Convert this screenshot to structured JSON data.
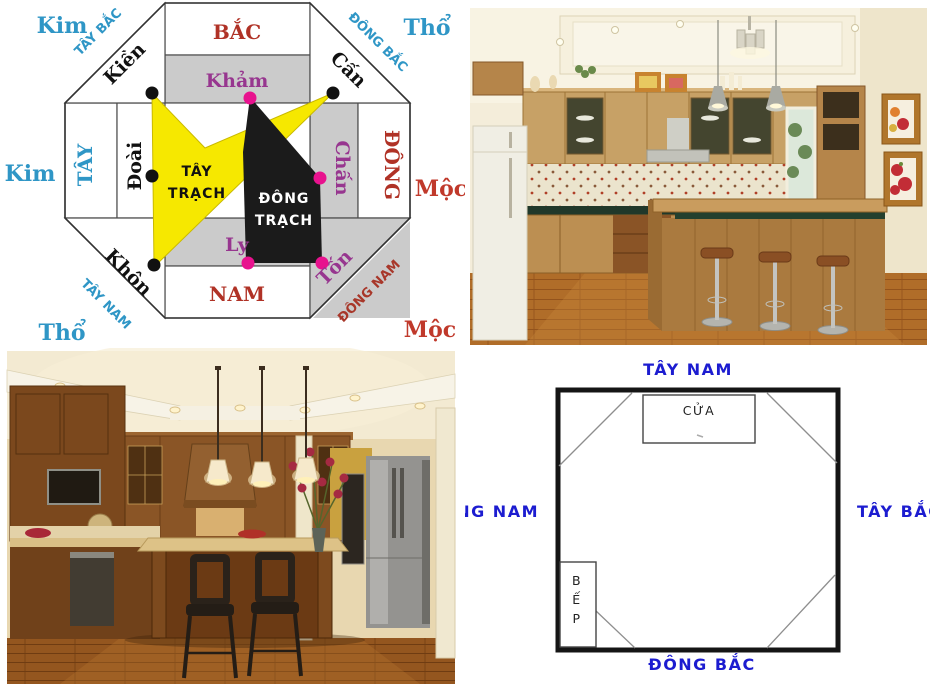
{
  "page": {
    "background": "#ffffff"
  },
  "bagua": {
    "elements": {
      "nw": "Kim",
      "ne": "Thổ",
      "w": "Kim",
      "e": "Mộc",
      "sw": "Thổ",
      "se": "Mộc"
    },
    "directions": {
      "n": "BẮC",
      "s": "NAM",
      "w": "TÂY",
      "e": "ĐÔNG",
      "nw": "TÂY BẮC",
      "ne": "ĐÔNG BẮC",
      "sw": "TÂY NAM",
      "se": "ĐÔNG NAM"
    },
    "trigrams": {
      "n": "Khảm",
      "s": "Ly",
      "w": "Đoài",
      "e": "Chấn",
      "nw": "Kiền",
      "ne": "Cấn",
      "sw": "Khôn",
      "se": "Tốn"
    },
    "west_house": {
      "line1": "TÂY",
      "line2": "TRẠCH"
    },
    "east_house": {
      "line1": "ĐÔNG",
      "line2": "TRẠCH"
    },
    "colors": {
      "element_blue": "#2f96c6",
      "element_red": "#c0392b",
      "cardinal_red": "#b03226",
      "trigram_purple": "#97368f",
      "diagonal_blue": "#2f96c6",
      "diagonal_red_dark": "#a8372a",
      "west_house_yellow": "#f6e800",
      "east_house_black": "#1b1b1b",
      "dot_black": "#111111",
      "dot_magenta": "#e8128e",
      "east_group_gray": "#cbcbcb"
    }
  },
  "floorplan": {
    "labels": {
      "top": "TÂY NAM",
      "bottom": "ĐÔNG BẮC",
      "left": "ĐÔNG NAM",
      "right": "TÂY BẮC"
    },
    "door_label": "CỬA",
    "stove_label": "BẾP",
    "stove_letters": [
      "B",
      "Ế",
      "P"
    ],
    "label_color": "#1c1cd0"
  }
}
